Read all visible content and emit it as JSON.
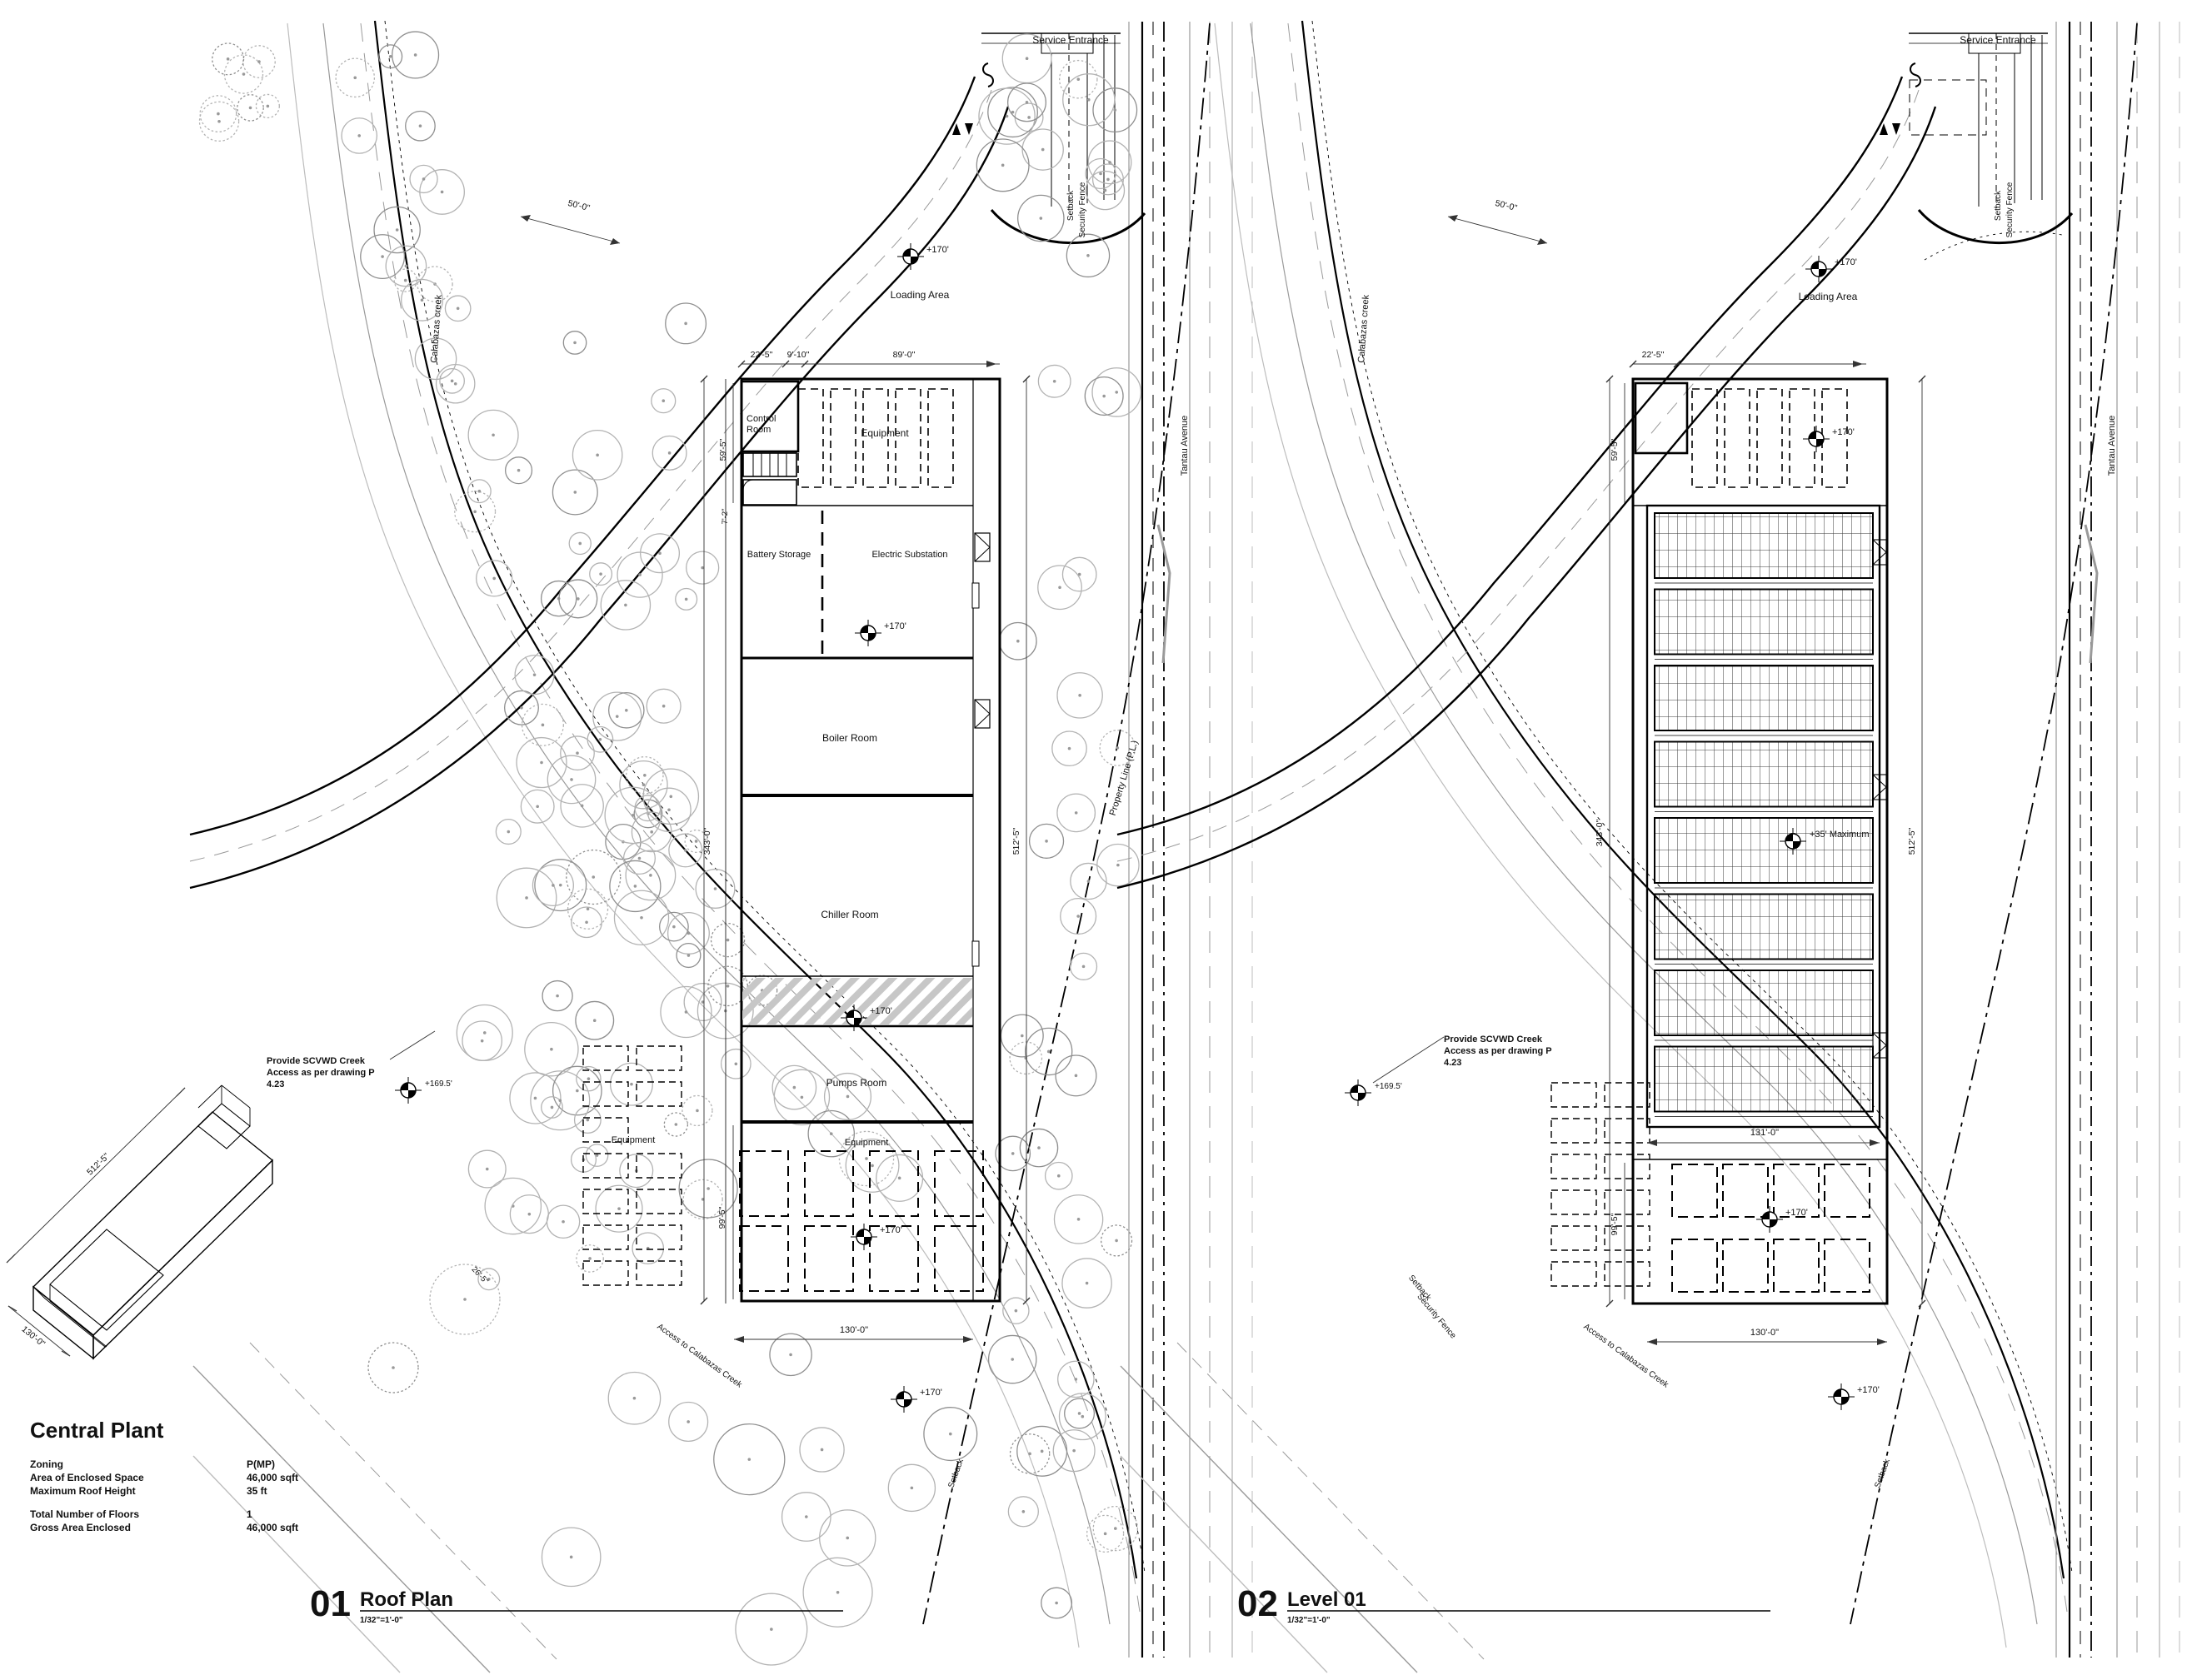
{
  "site": {
    "service_entrance": "Service Entrance",
    "loading_area": "Loading Area",
    "setback": "Setback",
    "security_fence": "Security Fence",
    "calabazas_creek": "Calabazas creek",
    "tantau_avenue": "Tantau Avenue",
    "access_creek": "Access to Calabazas Creek",
    "scvwd_l1": "Provide SCVWD Creek",
    "scvwd_l2": "Access as per drawing P",
    "scvwd_l3": "4.23",
    "spot_170": "+170'",
    "spot_169_5": "+169.5'",
    "dim_50": "50'-0\"",
    "dim_22_5": "22'-5\"",
    "dim_59_5": "59'-5\"",
    "dim_99_5": "99'-5\"",
    "dim_343": "343'-0\"",
    "dim_512": "512'-5\"",
    "dim_130": "130'-0\""
  },
  "left_plan": {
    "dim_9_10": "9'-10\"",
    "dim_89": "89'-0\"",
    "dim_7_2": "7'-2\"",
    "dim_26_5": "26'-5\"",
    "property_line": "Property Line (P.L.)",
    "rooms": {
      "control_l1": "Control",
      "control_l2": "Room",
      "equipment_top": "Equipment",
      "battery": "Battery Storage",
      "substation": "Electric Substation",
      "boiler": "Boiler Room",
      "chiller": "Chiller Room",
      "pumps": "Pumps Room",
      "equipment_bottom": "Equipment",
      "equipment_yard": "Equipment"
    }
  },
  "right_plan": {
    "dim_131": "131'-0\"",
    "spot_roof_max": "+35' Maximum"
  },
  "views": [
    {
      "number": "01",
      "title": "Roof Plan",
      "scale": "1/32\"=1'-0\""
    },
    {
      "number": "02",
      "title": "Level 01",
      "scale": "1/32\"=1'-0\""
    }
  ],
  "info_block": {
    "title": "Central Plant",
    "rows": [
      {
        "label": "Zoning",
        "value": "P(MP)"
      },
      {
        "label": "Area of Enclosed Space",
        "value": "46,000 sqft"
      },
      {
        "label": "Maximum Roof Height",
        "value": "35 ft"
      },
      {
        "label": "Total Number of Floors",
        "value": "1"
      },
      {
        "label": "Gross Area Enclosed",
        "value": "46,000 sqft"
      }
    ]
  },
  "isometric": {
    "dim_length": "512'-5\"",
    "dim_width": "130'-0\""
  }
}
